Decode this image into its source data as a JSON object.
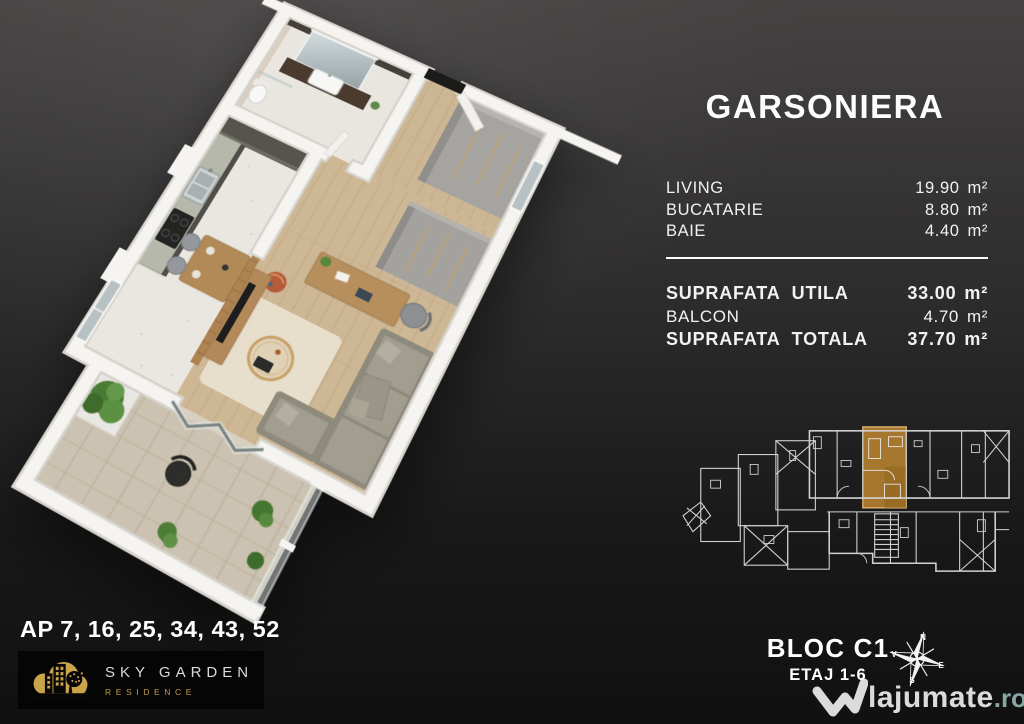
{
  "panel": {
    "title": "GARSONIERA",
    "rooms": [
      {
        "label": "LIVING",
        "value": "19.90",
        "unit": "m²"
      },
      {
        "label": "BUCATARIE",
        "value": "8.80",
        "unit": "m²"
      },
      {
        "label": "BAIE",
        "value": "4.40",
        "unit": "m²"
      }
    ],
    "totals": [
      {
        "label": "SUPRAFATA UTILA",
        "value": "33.00",
        "unit": "m²"
      },
      {
        "label": "BALCON",
        "value": "4.70",
        "unit": "m²"
      },
      {
        "label": "SUPRAFATA TOTALA",
        "value": "37.70",
        "unit": "m²"
      }
    ]
  },
  "apartments_line": "AP 7, 16, 25, 34, 43, 52",
  "brand": {
    "name": "SKY GARDEN",
    "sub": "RESIDENCE"
  },
  "block": {
    "name": "BLOC C1",
    "floors": "ETAJ 1-6"
  },
  "compass": {
    "n": "N",
    "e": "E",
    "s": "S",
    "v": "V"
  },
  "watermark": {
    "text": "lajumate",
    "tld": ".ro"
  },
  "colors": {
    "background_top": "#434040",
    "background_bottom": "#101010",
    "text": "#ffffff",
    "unit_highlight": "#b5812f",
    "brand_gold": "#c59d4e",
    "watermark_tld_teal": "#86a7a3"
  }
}
